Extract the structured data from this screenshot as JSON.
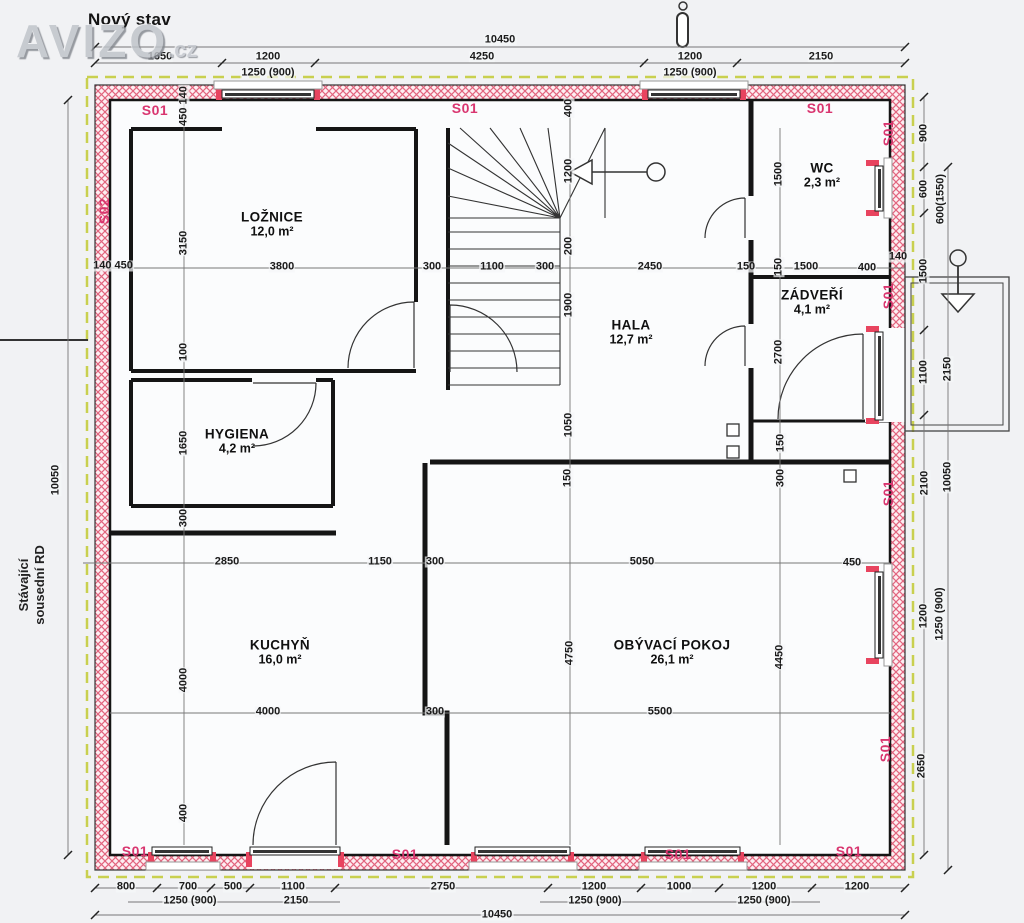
{
  "title": "Nový stav",
  "watermark": {
    "brand": "AVIZO",
    "tld": ".cz"
  },
  "neighbor_note": {
    "line1": "Stávající",
    "line2": "sousední RD"
  },
  "colors": {
    "construction_label": "#d9356f",
    "wall_hatch": "#e2647e",
    "boundary_dashed": "#c9d04f"
  },
  "rooms": [
    {
      "id": "loznice",
      "name": "LOŽNICE",
      "area": "12,0 m²",
      "x": 272,
      "y": 224
    },
    {
      "id": "wc",
      "name": "WC",
      "area": "2,3 m²",
      "x": 822,
      "y": 175
    },
    {
      "id": "zadveri",
      "name": "ZÁDVEŘÍ",
      "area": "4,1 m²",
      "x": 812,
      "y": 302
    },
    {
      "id": "hala",
      "name": "HALA",
      "area": "12,7 m²",
      "x": 631,
      "y": 332
    },
    {
      "id": "hygiena",
      "name": "HYGIENA",
      "area": "4,2 m²",
      "x": 237,
      "y": 441
    },
    {
      "id": "kuchyn",
      "name": "KUCHYŇ",
      "area": "16,0 m²",
      "x": 280,
      "y": 652
    },
    {
      "id": "obyvaci-pokoj",
      "name": "OBÝVACÍ POKOJ",
      "area": "26,1 m²",
      "x": 672,
      "y": 652
    }
  ],
  "construction_labels": [
    {
      "t": "S01",
      "x": 155,
      "y": 110,
      "r": 0
    },
    {
      "t": "S01",
      "x": 465,
      "y": 108,
      "r": 0
    },
    {
      "t": "S01",
      "x": 820,
      "y": 108,
      "r": 0
    },
    {
      "t": "S01",
      "x": 888,
      "y": 133,
      "r": 1
    },
    {
      "t": "S01",
      "x": 888,
      "y": 296,
      "r": 1
    },
    {
      "t": "S01",
      "x": 888,
      "y": 493,
      "r": 1
    },
    {
      "t": "S01",
      "x": 885,
      "y": 749,
      "r": 1
    },
    {
      "t": "S01",
      "x": 135,
      "y": 851,
      "r": 0
    },
    {
      "t": "S01",
      "x": 405,
      "y": 854,
      "r": 0
    },
    {
      "t": "S01",
      "x": 678,
      "y": 854,
      "r": 0
    },
    {
      "t": "S01",
      "x": 849,
      "y": 851,
      "r": 0
    },
    {
      "t": "S02",
      "x": 104,
      "y": 211,
      "r": 1
    }
  ],
  "dimensions": [
    {
      "t": "10450",
      "x": 500,
      "y": 40,
      "r": 0
    },
    {
      "t": "1650",
      "x": 160,
      "y": 57,
      "r": 0
    },
    {
      "t": "1200",
      "x": 268,
      "y": 57,
      "r": 0
    },
    {
      "t": "4250",
      "x": 482,
      "y": 57,
      "r": 0
    },
    {
      "t": "1200",
      "x": 690,
      "y": 57,
      "r": 0
    },
    {
      "t": "2150",
      "x": 821,
      "y": 57,
      "r": 0
    },
    {
      "t": "1250 (900)",
      "x": 268,
      "y": 73,
      "r": 0
    },
    {
      "t": "1250 (900)",
      "x": 690,
      "y": 73,
      "r": 0
    },
    {
      "t": "800",
      "x": 126,
      "y": 887,
      "r": 0
    },
    {
      "t": "700",
      "x": 188,
      "y": 887,
      "r": 0
    },
    {
      "t": "500",
      "x": 233,
      "y": 887,
      "r": 0
    },
    {
      "t": "1100",
      "x": 293,
      "y": 887,
      "r": 0
    },
    {
      "t": "2750",
      "x": 443,
      "y": 887,
      "r": 0
    },
    {
      "t": "1200",
      "x": 594,
      "y": 887,
      "r": 0
    },
    {
      "t": "1000",
      "x": 679,
      "y": 887,
      "r": 0
    },
    {
      "t": "1200",
      "x": 764,
      "y": 887,
      "r": 0
    },
    {
      "t": "1200",
      "x": 857,
      "y": 887,
      "r": 0
    },
    {
      "t": "1250 (900)",
      "x": 190,
      "y": 901,
      "r": 0
    },
    {
      "t": "2150",
      "x": 296,
      "y": 901,
      "r": 0
    },
    {
      "t": "1250 (900)",
      "x": 595,
      "y": 901,
      "r": 0
    },
    {
      "t": "1250 (900)",
      "x": 764,
      "y": 901,
      "r": 0
    },
    {
      "t": "10450",
      "x": 497,
      "y": 915,
      "r": 0
    },
    {
      "t": "10050",
      "x": 56,
      "y": 480,
      "r": 1
    },
    {
      "t": "900",
      "x": 924,
      "y": 133,
      "r": 1
    },
    {
      "t": "600",
      "x": 924,
      "y": 189,
      "r": 1
    },
    {
      "t": "1500",
      "x": 924,
      "y": 271,
      "r": 1
    },
    {
      "t": "1100",
      "x": 924,
      "y": 372,
      "r": 1
    },
    {
      "t": "2100",
      "x": 925,
      "y": 483,
      "r": 1
    },
    {
      "t": "1200",
      "x": 924,
      "y": 616,
      "r": 1
    },
    {
      "t": "2650",
      "x": 922,
      "y": 766,
      "r": 1
    },
    {
      "t": "600(1550)",
      "x": 941,
      "y": 199,
      "r": 1
    },
    {
      "t": "2150",
      "x": 948,
      "y": 369,
      "r": 1
    },
    {
      "t": "10050",
      "x": 948,
      "y": 477,
      "r": 1
    },
    {
      "t": "1250 (900)",
      "x": 940,
      "y": 614,
      "r": 1
    },
    {
      "t": "450 140",
      "x": 184,
      "y": 106,
      "r": 1
    },
    {
      "t": "3150",
      "x": 184,
      "y": 243,
      "r": 1
    },
    {
      "t": "100",
      "x": 184,
      "y": 352,
      "r": 1
    },
    {
      "t": "1650",
      "x": 184,
      "y": 443,
      "r": 1
    },
    {
      "t": "300",
      "x": 184,
      "y": 518,
      "r": 1
    },
    {
      "t": "4000",
      "x": 184,
      "y": 680,
      "r": 1
    },
    {
      "t": "400",
      "x": 184,
      "y": 813,
      "r": 1
    },
    {
      "t": "400",
      "x": 569,
      "y": 108,
      "r": 1
    },
    {
      "t": "1200",
      "x": 569,
      "y": 171,
      "r": 1
    },
    {
      "t": "200",
      "x": 569,
      "y": 246,
      "r": 1
    },
    {
      "t": "1900",
      "x": 569,
      "y": 305,
      "r": 1
    },
    {
      "t": "1050",
      "x": 569,
      "y": 425,
      "r": 1
    },
    {
      "t": "150",
      "x": 568,
      "y": 478,
      "r": 1
    },
    {
      "t": "4750",
      "x": 570,
      "y": 653,
      "r": 1
    },
    {
      "t": "1500",
      "x": 779,
      "y": 174,
      "r": 1
    },
    {
      "t": "150",
      "x": 779,
      "y": 267,
      "r": 1
    },
    {
      "t": "2700",
      "x": 779,
      "y": 352,
      "r": 1
    },
    {
      "t": "150",
      "x": 781,
      "y": 443,
      "r": 1
    },
    {
      "t": "300",
      "x": 781,
      "y": 478,
      "r": 1
    },
    {
      "t": "4450",
      "x": 780,
      "y": 657,
      "r": 1
    },
    {
      "t": "140 450",
      "x": 113,
      "y": 266,
      "r": 0
    },
    {
      "t": "3800",
      "x": 282,
      "y": 267,
      "r": 0
    },
    {
      "t": "300",
      "x": 432,
      "y": 267,
      "r": 0
    },
    {
      "t": "1100",
      "x": 492,
      "y": 267,
      "r": 0
    },
    {
      "t": "300",
      "x": 545,
      "y": 267,
      "r": 0
    },
    {
      "t": "2450",
      "x": 650,
      "y": 267,
      "r": 0
    },
    {
      "t": "150",
      "x": 746,
      "y": 267,
      "r": 0
    },
    {
      "t": "1500",
      "x": 806,
      "y": 267,
      "r": 0
    },
    {
      "t": "400",
      "x": 867,
      "y": 268,
      "r": 0
    },
    {
      "t": "140",
      "x": 898,
      "y": 257,
      "r": 0
    },
    {
      "t": "2850",
      "x": 227,
      "y": 562,
      "r": 0
    },
    {
      "t": "1150",
      "x": 380,
      "y": 562,
      "r": 0
    },
    {
      "t": "300",
      "x": 435,
      "y": 562,
      "r": 0
    },
    {
      "t": "5050",
      "x": 642,
      "y": 562,
      "r": 0
    },
    {
      "t": "450",
      "x": 852,
      "y": 563,
      "r": 0
    },
    {
      "t": "4000",
      "x": 268,
      "y": 712,
      "r": 0
    },
    {
      "t": "300",
      "x": 435,
      "y": 712,
      "r": 0
    },
    {
      "t": "5500",
      "x": 660,
      "y": 712,
      "r": 0
    }
  ]
}
